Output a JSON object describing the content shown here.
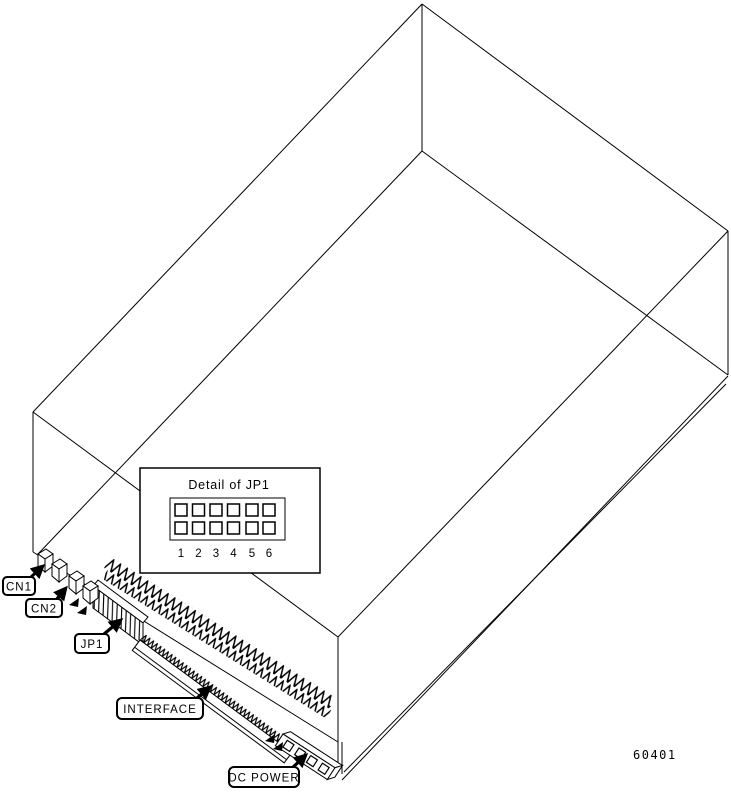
{
  "figure": {
    "id_number": "60401",
    "detail_inset": {
      "title": "Detail of JP1",
      "pin_numbers": [
        "1",
        "2",
        "3",
        "4",
        "5",
        "6"
      ]
    },
    "connector_labels": {
      "cn1": "CN1",
      "cn2": "CN2",
      "jp1": "JP1",
      "interface": "INTERFACE",
      "dc_power": "DC POWER"
    }
  }
}
